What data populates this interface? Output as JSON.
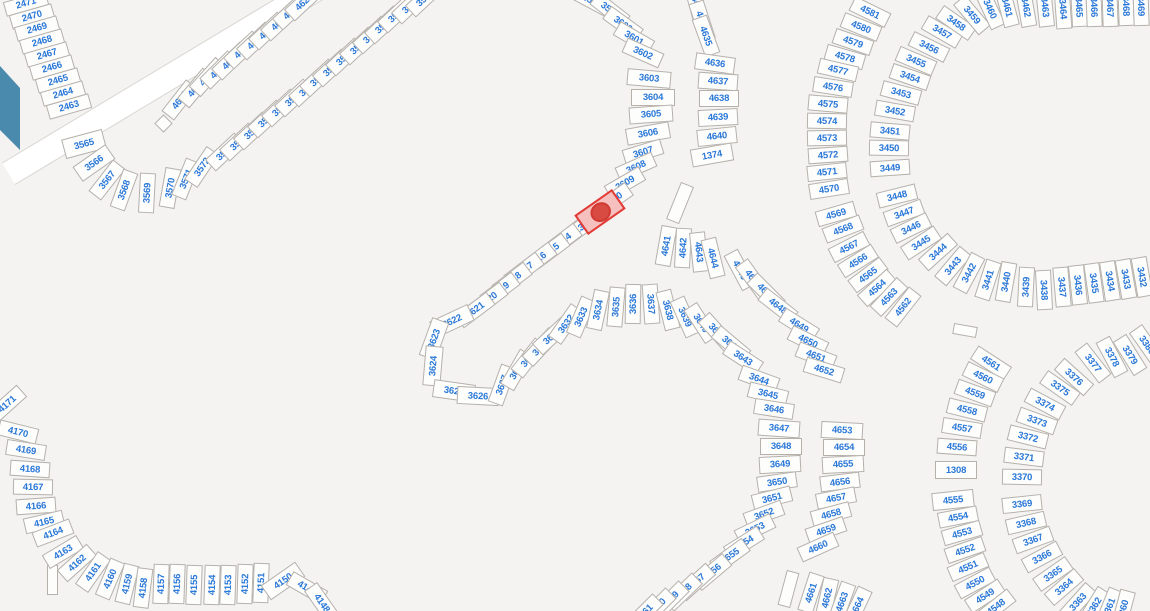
{
  "map": {
    "type": "parcel-plat-map",
    "background_color": "#f4f3f2",
    "lot_fill": "#fdfdfc",
    "lot_border": "#b5b0aa",
    "lot_number_color": "#2a78d8",
    "road_fill": "#ffffff",
    "road_edge": "#d8d5d1",
    "water_color": "#4a8aad",
    "selected_fill": "#f6c0be",
    "selected_border": "#e23a34",
    "selected_marker_color": "#d84b43"
  },
  "lots_format": "[number, center_x, center_y, rotation_deg, width_opt, height_opt]",
  "default_lot_size": {
    "w": 40,
    "h": 16
  },
  "selected_lot": {
    "label": "",
    "x": 600,
    "y": 212,
    "r": -35,
    "w": 46,
    "h": 24
  },
  "water": {
    "points": "0,66 20,88 20,150 0,130"
  },
  "roads": [
    {
      "x": 163,
      "y": 80,
      "w": 360,
      "h": 24,
      "r": -31
    }
  ],
  "structures": [
    {
      "x": 163,
      "y": 123,
      "w": 13,
      "h": 13,
      "r": -45
    },
    {
      "x": 680,
      "y": 203,
      "w": 14,
      "h": 40,
      "r": 22
    },
    {
      "x": 965,
      "y": 330,
      "w": 24,
      "h": 11,
      "r": 10
    },
    {
      "x": 788,
      "y": 589,
      "w": 13,
      "h": 36,
      "r": 15
    },
    {
      "x": 52,
      "y": 580,
      "w": 11,
      "h": 30,
      "r": 0
    }
  ],
  "lots": [
    [
      "2471",
      26,
      3,
      -16,
      44,
      15
    ],
    [
      "2470",
      32,
      16,
      -16,
      44,
      15
    ],
    [
      "2469",
      37,
      28,
      -16,
      44,
      15
    ],
    [
      "2468",
      42,
      41,
      -16,
      44,
      15
    ],
    [
      "2467",
      47,
      54,
      -16,
      44,
      15
    ],
    [
      "2466",
      52,
      67,
      -16,
      44,
      15
    ],
    [
      "2465",
      58,
      80,
      -16,
      44,
      15
    ],
    [
      "2464",
      63,
      93,
      -16,
      44,
      15
    ],
    [
      "2463",
      69,
      106,
      -16,
      44,
      15
    ],
    [
      "4612",
      180,
      100,
      -52
    ],
    [
      "4613",
      196,
      88,
      -50
    ],
    [
      "4614",
      208,
      77,
      -48
    ],
    [
      "4615",
      219,
      70,
      -45
    ],
    [
      "4616",
      231,
      61,
      -44
    ],
    [
      "4617",
      243,
      50,
      -43
    ],
    [
      "4618",
      256,
      41,
      -43
    ],
    [
      "4619",
      268,
      31,
      -43
    ],
    [
      "4620",
      280,
      22,
      -43
    ],
    [
      "4621",
      292,
      11,
      -43
    ],
    [
      "4622",
      304,
      2,
      -43
    ],
    [
      "3565",
      84,
      144,
      -15,
      42,
      20
    ],
    [
      "3566",
      94,
      163,
      -35,
      40,
      18
    ],
    [
      "3567",
      107,
      180,
      -52
    ],
    [
      "3568",
      124,
      190,
      -70
    ],
    [
      "3569",
      147,
      193,
      -87
    ],
    [
      "3570",
      170,
      188,
      -80
    ],
    [
      "3571",
      186,
      179,
      -68
    ],
    [
      "3572",
      202,
      167,
      -56
    ],
    [
      "3573",
      225,
      152,
      -43
    ],
    [
      "3574",
      239,
      142,
      -43
    ],
    [
      "3575",
      253,
      131,
      -43
    ],
    [
      "3576",
      267,
      119,
      -43
    ],
    [
      "3577",
      281,
      108,
      -43
    ],
    [
      "3578",
      294,
      98,
      -43
    ],
    [
      "3579",
      308,
      88,
      -43
    ],
    [
      "3580",
      319,
      78,
      -43
    ],
    [
      "3581",
      332,
      68,
      -43
    ],
    [
      "3582",
      345,
      57,
      -43
    ],
    [
      "3583",
      359,
      46,
      -43
    ],
    [
      "3584",
      372,
      35,
      -43
    ],
    [
      "3585",
      384,
      25,
      -43
    ],
    [
      "3586",
      397,
      14,
      -43
    ],
    [
      "3587",
      411,
      5,
      -43
    ],
    [
      "3588",
      425,
      -2,
      -43
    ],
    [
      "3598",
      592,
      1,
      28
    ],
    [
      "3599",
      610,
      10,
      38
    ],
    [
      "3600",
      623,
      24,
      36
    ],
    [
      "3601",
      634,
      38,
      30
    ],
    [
      "3602",
      643,
      53,
      24
    ],
    [
      "3603",
      649,
      78,
      5,
      44,
      17
    ],
    [
      "3604",
      653,
      97,
      0,
      44,
      17
    ],
    [
      "3605",
      651,
      114,
      -4,
      44,
      17
    ],
    [
      "3606",
      648,
      133,
      -10,
      44,
      17
    ],
    [
      "3607",
      643,
      152,
      -17
    ],
    [
      "3608",
      636,
      167,
      -24
    ],
    [
      "3609",
      625,
      183,
      -30
    ],
    [
      "3610",
      613,
      200,
      -35
    ],
    [
      "3612",
      587,
      222,
      -37
    ],
    [
      "3613",
      575,
      232,
      -37
    ],
    [
      "3614",
      562,
      241,
      -37
    ],
    [
      "3615",
      550,
      251,
      -37
    ],
    [
      "3616",
      537,
      260,
      -37
    ],
    [
      "3617",
      524,
      270,
      -37
    ],
    [
      "3618",
      512,
      280,
      -37
    ],
    [
      "3619",
      500,
      290,
      -37
    ],
    [
      "3620",
      488,
      300,
      -37
    ],
    [
      "3621",
      475,
      310,
      -37
    ],
    [
      "3622",
      452,
      321,
      -25,
      42,
      18
    ],
    [
      "3623",
      434,
      339,
      -70,
      40,
      18
    ],
    [
      "3624",
      433,
      366,
      -85,
      40,
      18
    ],
    [
      "3625",
      454,
      391,
      8,
      42,
      18
    ],
    [
      "3626",
      478,
      396,
      3,
      42,
      18
    ],
    [
      "3627",
      502,
      385,
      -70
    ],
    [
      "3628",
      517,
      370,
      -60
    ],
    [
      "3629",
      529,
      358,
      -52
    ],
    [
      "3630",
      541,
      347,
      -47
    ],
    [
      "3631",
      552,
      336,
      -43
    ],
    [
      "3632",
      566,
      324,
      -55
    ],
    [
      "3633",
      581,
      317,
      -67
    ],
    [
      "3634",
      598,
      310,
      -78
    ],
    [
      "3635",
      616,
      307,
      -85
    ],
    [
      "3636",
      633,
      304,
      -89
    ],
    [
      "3637",
      651,
      304,
      86
    ],
    [
      "3638",
      668,
      310,
      76
    ],
    [
      "3639",
      685,
      317,
      66
    ],
    [
      "3640",
      701,
      323,
      57
    ],
    [
      "3641",
      717,
      332,
      48
    ],
    [
      "3642",
      731,
      344,
      40
    ],
    [
      "3643",
      743,
      358,
      33
    ],
    [
      "3644",
      759,
      379,
      20
    ],
    [
      "3645",
      768,
      394,
      14
    ],
    [
      "3646",
      774,
      409,
      9
    ],
    [
      "3647",
      779,
      428,
      4,
      42,
      17
    ],
    [
      "3648",
      781,
      446,
      0,
      42,
      17
    ],
    [
      "3649",
      780,
      464,
      -3,
      42,
      17
    ],
    [
      "3650",
      777,
      482,
      -8
    ],
    [
      "3651",
      772,
      498,
      -14
    ],
    [
      "3652",
      764,
      514,
      -20
    ],
    [
      "3653",
      755,
      529,
      -26
    ],
    [
      "3654",
      744,
      543,
      -32
    ],
    [
      "3655",
      730,
      556,
      -36
    ],
    [
      "3656",
      712,
      572,
      -40
    ],
    [
      "3657",
      696,
      582,
      -42
    ],
    [
      "3658",
      683,
      592,
      -44
    ],
    [
      "3659",
      670,
      600,
      -45
    ],
    [
      "3660",
      657,
      607,
      -45
    ],
    [
      "3661",
      644,
      613,
      -45
    ],
    [
      "4633",
      697,
      6,
      75
    ],
    [
      "4634",
      702,
      21,
      72
    ],
    [
      "4635",
      706,
      36,
      70
    ],
    [
      "4636",
      715,
      63,
      8,
      40,
      17
    ],
    [
      "4637",
      718,
      81,
      4,
      40,
      17
    ],
    [
      "4638",
      719,
      98,
      0,
      40,
      17
    ],
    [
      "4639",
      718,
      117,
      -3,
      40,
      17
    ],
    [
      "4640",
      717,
      136,
      -6,
      40,
      17
    ],
    [
      "1374",
      712,
      155,
      -10,
      42,
      18
    ],
    [
      "4641",
      666,
      246,
      -80
    ],
    [
      "4642",
      683,
      248,
      -87
    ],
    [
      "4643",
      699,
      252,
      84
    ],
    [
      "4644",
      713,
      258,
      76
    ],
    [
      "4645",
      740,
      270,
      62
    ],
    [
      "4646",
      753,
      279,
      54
    ],
    [
      "4647",
      766,
      292,
      45
    ],
    [
      "4648",
      778,
      306,
      38
    ],
    [
      "4649",
      799,
      325,
      32
    ],
    [
      "4650",
      808,
      341,
      26
    ],
    [
      "4651",
      816,
      356,
      21
    ],
    [
      "4652",
      824,
      370,
      17
    ],
    [
      "4653",
      842,
      430,
      3,
      42,
      17
    ],
    [
      "4654",
      844,
      447,
      0,
      42,
      17
    ],
    [
      "4655",
      843,
      464,
      -3,
      42,
      17
    ],
    [
      "4656",
      840,
      482,
      -7
    ],
    [
      "4657",
      836,
      498,
      -11
    ],
    [
      "4658",
      831,
      514,
      -15
    ],
    [
      "4659",
      826,
      530,
      -19
    ],
    [
      "4660",
      818,
      547,
      -24
    ],
    [
      "4661",
      811,
      593,
      -72
    ],
    [
      "4662",
      827,
      598,
      -77
    ],
    [
      "4663",
      842,
      602,
      -70
    ],
    [
      "4664",
      857,
      607,
      -65
    ],
    [
      "4581",
      870,
      12,
      26
    ],
    [
      "4580",
      861,
      27,
      22
    ],
    [
      "4579",
      853,
      42,
      19
    ],
    [
      "4578",
      845,
      57,
      16
    ],
    [
      "4577",
      838,
      70,
      13
    ],
    [
      "4576",
      833,
      87,
      9
    ],
    [
      "4575",
      828,
      104,
      5
    ],
    [
      "4574",
      827,
      121,
      1
    ],
    [
      "4573",
      827,
      138,
      -1
    ],
    [
      "4572",
      828,
      155,
      -4
    ],
    [
      "4571",
      827,
      172,
      -6
    ],
    [
      "4570",
      829,
      189,
      -9
    ],
    [
      "4569",
      836,
      214,
      -16
    ],
    [
      "4568",
      843,
      229,
      -21
    ],
    [
      "4567",
      849,
      247,
      -27
    ],
    [
      "4566",
      858,
      261,
      -32
    ],
    [
      "4565",
      868,
      275,
      -37
    ],
    [
      "4564",
      877,
      288,
      -42
    ],
    [
      "4563",
      889,
      297,
      -47
    ],
    [
      "4562",
      903,
      307,
      -52
    ],
    [
      "3457",
      942,
      32,
      30
    ],
    [
      "3456",
      929,
      47,
      26
    ],
    [
      "3455",
      916,
      61,
      23
    ],
    [
      "3454",
      910,
      77,
      19
    ],
    [
      "3453",
      901,
      93,
      15
    ],
    [
      "3452",
      895,
      111,
      10
    ],
    [
      "3451",
      890,
      131,
      5
    ],
    [
      "3450",
      889,
      148,
      1
    ],
    [
      "3449",
      890,
      168,
      -4
    ],
    [
      "3448",
      897,
      196,
      -14
    ],
    [
      "3447",
      904,
      213,
      -20
    ],
    [
      "3446",
      911,
      228,
      -26
    ],
    [
      "3445",
      921,
      243,
      -33
    ],
    [
      "3444",
      938,
      252,
      -42
    ],
    [
      "3443",
      953,
      266,
      -50
    ],
    [
      "3442",
      969,
      273,
      -62
    ],
    [
      "3441",
      988,
      280,
      -72
    ],
    [
      "3440",
      1006,
      282,
      -80
    ],
    [
      "3439",
      1026,
      287,
      -87
    ],
    [
      "3438",
      1044,
      290,
      87
    ],
    [
      "3437",
      1062,
      287,
      85
    ],
    [
      "3436",
      1078,
      285,
      84
    ],
    [
      "3435",
      1094,
      283,
      82
    ],
    [
      "3434",
      1110,
      281,
      81
    ],
    [
      "3433",
      1126,
      279,
      80
    ],
    [
      "3432",
      1142,
      277,
      80
    ],
    [
      "3458",
      956,
      23,
      35
    ],
    [
      "3459",
      972,
      15,
      50
    ],
    [
      "3460",
      990,
      9,
      65
    ],
    [
      "3461",
      1007,
      7,
      75
    ],
    [
      "3462",
      1026,
      7,
      80
    ],
    [
      "3463",
      1045,
      7,
      84
    ],
    [
      "3464",
      1063,
      9,
      86
    ],
    [
      "3465",
      1079,
      7,
      87
    ],
    [
      "3466",
      1094,
      7,
      88
    ],
    [
      "3467",
      1110,
      7,
      88
    ],
    [
      "3468",
      1126,
      6,
      88
    ],
    [
      "3469",
      1141,
      6,
      88
    ],
    [
      "4561",
      991,
      363,
      33
    ],
    [
      "4560",
      983,
      377,
      26
    ],
    [
      "4559",
      975,
      393,
      20
    ],
    [
      "4558",
      967,
      410,
      14
    ],
    [
      "4557",
      962,
      428,
      9
    ],
    [
      "4556",
      957,
      447,
      4
    ],
    [
      "1308",
      956,
      470,
      0,
      42,
      18
    ],
    [
      "4555",
      953,
      500,
      -6,
      42,
      18
    ],
    [
      "4554",
      958,
      517,
      -11
    ],
    [
      "4553",
      962,
      533,
      -16
    ],
    [
      "4552",
      965,
      550,
      -19
    ],
    [
      "4551",
      968,
      567,
      -23
    ],
    [
      "4550",
      975,
      583,
      -28
    ],
    [
      "4549",
      985,
      596,
      -33
    ],
    [
      "4548",
      996,
      607,
      -38
    ],
    [
      "3380",
      1147,
      345,
      55
    ],
    [
      "3379",
      1130,
      355,
      58
    ],
    [
      "3378",
      1112,
      357,
      62
    ],
    [
      "3377",
      1093,
      363,
      52
    ],
    [
      "3376",
      1074,
      377,
      42
    ],
    [
      "3375",
      1060,
      388,
      35
    ],
    [
      "3374",
      1045,
      404,
      28
    ],
    [
      "3373",
      1037,
      421,
      20
    ],
    [
      "3372",
      1028,
      437,
      14
    ],
    [
      "3371",
      1024,
      457,
      7
    ],
    [
      "3370",
      1022,
      477,
      1
    ],
    [
      "3369",
      1022,
      504,
      -6
    ],
    [
      "3368",
      1026,
      523,
      -13
    ],
    [
      "3367",
      1033,
      540,
      -20
    ],
    [
      "3366",
      1042,
      557,
      -28
    ],
    [
      "3365",
      1053,
      574,
      -35
    ],
    [
      "3364",
      1064,
      587,
      -41
    ],
    [
      "3363",
      1078,
      602,
      -48
    ],
    [
      "3362",
      1094,
      607,
      -58
    ],
    [
      "3361",
      1109,
      608,
      -68
    ],
    [
      "3360",
      1123,
      610,
      -75
    ],
    [
      "4171",
      7,
      404,
      -42
    ],
    [
      "4170",
      18,
      432,
      14
    ],
    [
      "4169",
      26,
      450,
      9
    ],
    [
      "4168",
      30,
      469,
      4
    ],
    [
      "4167",
      33,
      487,
      1
    ],
    [
      "4166",
      36,
      506,
      -4
    ],
    [
      "4165",
      44,
      522,
      -13
    ],
    [
      "4164",
      53,
      533,
      -21
    ],
    [
      "4163",
      63,
      552,
      -31
    ],
    [
      "4162",
      77,
      563,
      -42
    ],
    [
      "4161",
      93,
      572,
      -55
    ],
    [
      "4160",
      110,
      579,
      -67
    ],
    [
      "4159",
      127,
      584,
      -76
    ],
    [
      "4158",
      143,
      588,
      -83
    ],
    [
      "4157",
      161,
      584,
      -88
    ],
    [
      "4156",
      177,
      584,
      -88
    ],
    [
      "4155",
      194,
      585,
      -88
    ],
    [
      "4154",
      212,
      585,
      -88
    ],
    [
      "4153",
      228,
      585,
      -88
    ],
    [
      "4152",
      245,
      584,
      -88
    ],
    [
      "4151",
      261,
      583,
      -88
    ],
    [
      "4150",
      283,
      581,
      -35,
      42,
      18
    ],
    [
      "4149",
      307,
      588,
      30
    ],
    [
      "4148",
      322,
      603,
      55
    ]
  ]
}
